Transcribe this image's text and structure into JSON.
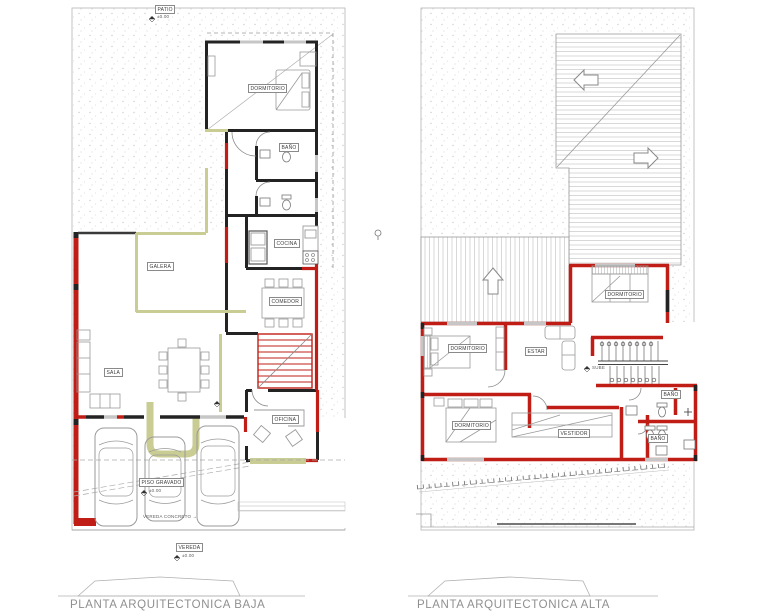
{
  "palette": {
    "wall_black": "#232323",
    "wall_red": "#bf1d15",
    "wall_olive": "#c9cc93",
    "line_gray": "#9a9a9a",
    "caption_gray": "#8f8f8f"
  },
  "site": {
    "level_text": "±0.00"
  },
  "plan_baja": {
    "caption": "PLANTA ARQUITECTONICA BAJA",
    "labels": {
      "patio": "PATIO",
      "dormitorio": "DORMITORIO",
      "bano": "BAÑO",
      "cocina": "COCINA",
      "comedor": "COMEDOR",
      "galera": "GALERA",
      "sala": "SALA",
      "oficina": "OFICINA",
      "piso_gravado": "PISO GRAVADO",
      "vereda_concreto": "VEREDA CONCRETO →",
      "vereda": "VEREDA"
    }
  },
  "plan_alta": {
    "caption": "PLANTA ARQUITECTONICA ALTA",
    "labels": {
      "dormitorio_1": "DORMITORIO",
      "dormitorio_2": "DORMITORIO",
      "dormitorio_3": "DORMITORIO",
      "estar": "ESTAR",
      "vestidor": "VESTIDOR",
      "bano_1": "BAÑO",
      "bano_2": "BAÑO",
      "sube": "SUBE"
    }
  }
}
